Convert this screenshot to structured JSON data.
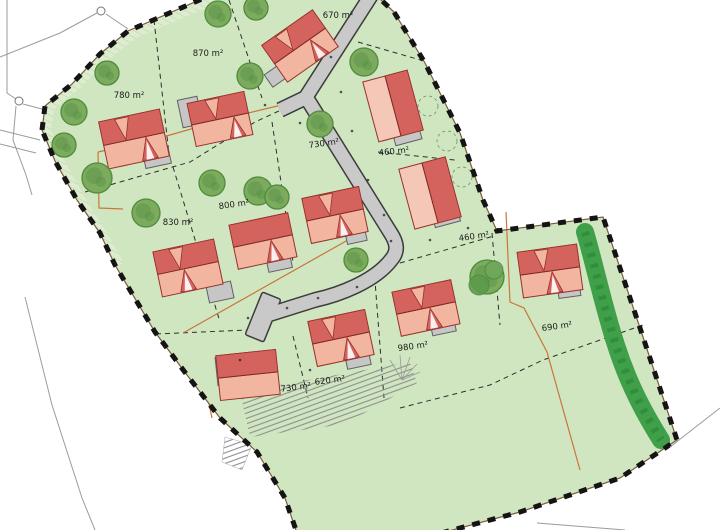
{
  "canvas": {
    "w": 720,
    "h": 530
  },
  "plots": [
    {
      "label": "670 m²",
      "x": 338,
      "y": 16,
      "rot": 0
    },
    {
      "label": "870 m²",
      "x": 208,
      "y": 54,
      "rot": 0
    },
    {
      "label": "780 m²",
      "x": 129,
      "y": 96,
      "rot": 0
    },
    {
      "label": "730 m²",
      "x": 324,
      "y": 144,
      "rot": -8
    },
    {
      "label": "460 m²",
      "x": 394,
      "y": 152,
      "rot": -6
    },
    {
      "label": "460 m²",
      "x": 474,
      "y": 237,
      "rot": -8
    },
    {
      "label": "800 m²",
      "x": 234,
      "y": 205,
      "rot": -8
    },
    {
      "label": "830 m²",
      "x": 178,
      "y": 223,
      "rot": 0
    },
    {
      "label": "730 m²",
      "x": 296,
      "y": 388,
      "rot": -7
    },
    {
      "label": "620 m²",
      "x": 330,
      "y": 381,
      "rot": -7
    },
    {
      "label": "980 m²",
      "x": 413,
      "y": 347,
      "rot": -8
    },
    {
      "label": "690 m²",
      "x": 557,
      "y": 327,
      "rot": -8
    }
  ],
  "colors": {
    "site_green": "#cfe6c0",
    "band_green": "#ddecce",
    "hatch_green": "#b7d2a5",
    "road_gray": "#c9c9c9",
    "road_edge": "#3c3c3c",
    "roof_dark": "#d4635e",
    "roof_light": "#f2b5a0",
    "roof_light2": "#f4c7b6",
    "roof_stroke": "#98302a",
    "garage_fill": "#c6c6c6",
    "garage_stroke": "#606060",
    "tree_fill": "#7cab5e",
    "tree_stroke": "#4e8c3c",
    "tree_inner": "#659a4e",
    "veg_green": "#3fa049",
    "veg_dark": "#2e8a3b",
    "dash_line": "#2e2e2e",
    "orange": "#c8763a",
    "boundary": "#141414",
    "boundary_under": "#7a5a3d",
    "outside": "#9b9b9b",
    "tick": "#8f8f8f",
    "label": "#1b1b1b"
  },
  "site": {
    "boundary": [
      [
        42,
        130
      ],
      [
        45,
        106
      ],
      [
        72,
        84
      ],
      [
        100,
        54
      ],
      [
        128,
        31
      ],
      [
        211,
        -5
      ],
      [
        378,
        -3
      ],
      [
        394,
        12
      ],
      [
        425,
        63
      ],
      [
        460,
        133
      ],
      [
        483,
        200
      ],
      [
        497,
        231
      ],
      [
        603,
        217
      ],
      [
        641,
        331
      ],
      [
        677,
        440
      ],
      [
        620,
        478
      ],
      [
        520,
        512
      ],
      [
        430,
        536
      ],
      [
        298,
        536
      ],
      [
        285,
        498
      ],
      [
        257,
        452
      ],
      [
        220,
        418
      ],
      [
        187,
        375
      ],
      [
        155,
        332
      ],
      [
        115,
        265
      ],
      [
        100,
        233
      ],
      [
        77,
        200
      ],
      [
        55,
        161
      ],
      [
        42,
        130
      ]
    ],
    "band": [
      [
        211,
        -4
      ],
      [
        128,
        31
      ],
      [
        100,
        54
      ],
      [
        72,
        84
      ],
      [
        45,
        106
      ],
      [
        42,
        130
      ],
      [
        58,
        163
      ],
      [
        78,
        202
      ],
      [
        100,
        235
      ],
      [
        116,
        266
      ],
      [
        124,
        263
      ],
      [
        107,
        233
      ],
      [
        86,
        200
      ],
      [
        65,
        162
      ],
      [
        51,
        130
      ],
      [
        54,
        109
      ],
      [
        80,
        88
      ],
      [
        107,
        61
      ],
      [
        136,
        38
      ],
      [
        216,
        4
      ]
    ],
    "plot_lines": [
      [
        [
          229,
          0
        ],
        [
          262,
          98
        ]
      ],
      [
        [
          154,
          20
        ],
        [
          170,
          163
        ]
      ],
      [
        [
          85,
          192
        ],
        [
          190,
          162
        ],
        [
          255,
          122
        ],
        [
          281,
          110
        ]
      ],
      [
        [
          173,
          167
        ],
        [
          220,
          322
        ]
      ],
      [
        [
          156,
          334
        ],
        [
          248,
          330
        ]
      ],
      [
        [
          272,
          122
        ],
        [
          293,
          262
        ]
      ],
      [
        [
          293,
          336
        ],
        [
          308,
          398
        ]
      ],
      [
        [
          374,
          268
        ],
        [
          384,
          398
        ]
      ],
      [
        [
          492,
          233
        ],
        [
          500,
          325
        ]
      ],
      [
        [
          400,
          408
        ],
        [
          490,
          385
        ],
        [
          543,
          360
        ],
        [
          643,
          325
        ]
      ],
      [
        [
          400,
          263
        ],
        [
          494,
          236
        ]
      ],
      [
        [
          378,
          152
        ],
        [
          455,
          160
        ]
      ],
      [
        [
          358,
          42
        ],
        [
          424,
          61
        ]
      ]
    ],
    "orange_lines": [
      [
        [
          98,
          152
        ],
        [
          170,
          135
        ],
        [
          240,
          115
        ],
        [
          298,
          101
        ]
      ],
      [
        [
          98,
          152
        ],
        [
          99,
          208
        ],
        [
          123,
          209
        ]
      ],
      [
        [
          183,
          333
        ],
        [
          355,
          236
        ]
      ],
      [
        [
          506,
          212
        ],
        [
          510,
          302
        ],
        [
          524,
          308
        ],
        [
          547,
          352
        ],
        [
          580,
          470
        ]
      ],
      [
        [
          209,
          404
        ],
        [
          212,
          418
        ]
      ]
    ],
    "road_path": "M372,-6 L306,97 L390,232 C398,244 398,252 391,260 C374,282 338,295 315,300 L264,316 M305,98 L280,110",
    "hammerhead": {
      "cx": 263,
      "cy": 317,
      "w": 20,
      "h": 46,
      "rot": 22
    },
    "veg_path": "M585,232 C593,258 603,305 616,345 C629,386 646,416 661,440",
    "houses": [
      {
        "cx": 300,
        "cy": 46,
        "w": 62,
        "h": 45,
        "rot": -35,
        "split": "h",
        "g": {
          "cx": 280,
          "cy": 73,
          "w": 28,
          "h": 15,
          "rot": -35
        },
        "pt": -8,
        "pb": 12
      },
      {
        "cx": 220,
        "cy": 119,
        "w": 58,
        "h": 44,
        "rot": -12,
        "split": "h",
        "g": {
          "cx": 190,
          "cy": 112,
          "w": 20,
          "h": 28,
          "rot": -12
        },
        "pt": -4,
        "pb": 14
      },
      {
        "cx": 134,
        "cy": 139,
        "w": 62,
        "h": 48,
        "rot": -12,
        "split": "h",
        "g": {
          "cx": 157,
          "cy": 158,
          "w": 26,
          "h": 16,
          "rot": -12
        },
        "pt": -8,
        "pb": 12
      },
      {
        "cx": 393,
        "cy": 106,
        "w": 46,
        "h": 62,
        "rot": -15,
        "split": "v",
        "g": {
          "cx": 407,
          "cy": 135,
          "w": 27,
          "h": 15,
          "rot": -15
        }
      },
      {
        "cx": 430,
        "cy": 193,
        "w": 48,
        "h": 62,
        "rot": -15,
        "split": "v",
        "g": {
          "cx": 446,
          "cy": 217,
          "w": 26,
          "h": 15,
          "rot": -15
        }
      },
      {
        "cx": 263,
        "cy": 241,
        "w": 60,
        "h": 45,
        "rot": -12,
        "split": "h",
        "g": {
          "cx": 279,
          "cy": 262,
          "w": 24,
          "h": 16,
          "rot": -12
        },
        "pb": 8
      },
      {
        "cx": 335,
        "cy": 215,
        "w": 58,
        "h": 46,
        "rot": -12,
        "split": "h",
        "g": {
          "cx": 356,
          "cy": 236,
          "w": 20,
          "h": 13,
          "rot": -12
        },
        "pt": -5,
        "pb": 5
      },
      {
        "cx": 188,
        "cy": 268,
        "w": 62,
        "h": 46,
        "rot": -12,
        "split": "h",
        "g": {
          "cx": 220,
          "cy": 292,
          "w": 25,
          "h": 17,
          "rot": -12
        },
        "pt": -8,
        "pb": -4
      },
      {
        "cx": 341,
        "cy": 338,
        "w": 58,
        "h": 46,
        "rot": -12,
        "split": "h",
        "g": {
          "cx": 358,
          "cy": 360,
          "w": 24,
          "h": 14,
          "rot": -12
        },
        "pt": -8,
        "pb": 6
      },
      {
        "cx": 426,
        "cy": 308,
        "w": 60,
        "h": 45,
        "rot": -12,
        "split": "h",
        "g": {
          "cx": 443,
          "cy": 326,
          "w": 24,
          "h": 15,
          "rot": -12
        },
        "pt": -4,
        "pb": 4
      },
      {
        "cx": 550,
        "cy": 271,
        "w": 60,
        "h": 46,
        "rot": -8,
        "split": "h",
        "g": {
          "cx": 569,
          "cy": 290,
          "w": 22,
          "h": 14,
          "rot": -8
        },
        "pt": -6,
        "pb": 2
      },
      {
        "cx": 248,
        "cy": 375,
        "w": 60,
        "h": 45,
        "rot": -6,
        "split": "h",
        "g": {
          "cx": 223,
          "cy": 371,
          "w": 13,
          "h": 28,
          "rot": -6
        }
      }
    ],
    "trees": [
      {
        "x": 256,
        "y": 8,
        "r": 12
      },
      {
        "x": 218,
        "y": 14,
        "r": 13
      },
      {
        "x": 107,
        "y": 73,
        "r": 12
      },
      {
        "x": 74,
        "y": 112,
        "r": 13
      },
      {
        "x": 64,
        "y": 145,
        "r": 12
      },
      {
        "x": 97,
        "y": 178,
        "r": 15
      },
      {
        "x": 146,
        "y": 213,
        "r": 14
      },
      {
        "x": 212,
        "y": 183,
        "r": 13
      },
      {
        "x": 250,
        "y": 76,
        "r": 13
      },
      {
        "x": 320,
        "y": 124,
        "r": 13
      },
      {
        "x": 364,
        "y": 62,
        "r": 14
      },
      {
        "x": 258,
        "y": 191,
        "r": 14
      },
      {
        "x": 277,
        "y": 197,
        "r": 12
      },
      {
        "x": 356,
        "y": 260,
        "r": 12
      },
      {
        "x": 487,
        "y": 277,
        "r": 17,
        "big": true
      }
    ],
    "dashed_circles": [
      {
        "x": 428,
        "y": 106
      },
      {
        "x": 447,
        "y": 141
      },
      {
        "x": 462,
        "y": 177
      }
    ],
    "hatch_band": [
      [
        240,
        392
      ],
      [
        410,
        362
      ],
      [
        417,
        383
      ],
      [
        345,
        424
      ],
      [
        250,
        437
      ]
    ],
    "hatch_wedge": [
      [
        225,
        437
      ],
      [
        252,
        445
      ],
      [
        242,
        470
      ],
      [
        222,
        462
      ]
    ],
    "fan_lines": [
      [
        [
          402,
          380
        ],
        [
          390,
          360
        ]
      ],
      [
        [
          402,
          380
        ],
        [
          400,
          355
        ]
      ],
      [
        [
          402,
          380
        ],
        [
          410,
          357
        ]
      ],
      [
        [
          402,
          380
        ],
        [
          417,
          364
        ]
      ],
      [
        [
          402,
          380
        ],
        [
          420,
          372
        ]
      ]
    ],
    "dots": [
      [
        331,
        57
      ],
      [
        341,
        92
      ],
      [
        352,
        131
      ],
      [
        368,
        180
      ],
      [
        384,
        215
      ],
      [
        391,
        241
      ],
      [
        357,
        287
      ],
      [
        318,
        298
      ],
      [
        287,
        308
      ],
      [
        300,
        123
      ],
      [
        265,
        105
      ],
      [
        248,
        318
      ],
      [
        430,
        240
      ],
      [
        468,
        228
      ],
      [
        240,
        360
      ],
      [
        310,
        370
      ]
    ],
    "outside_lines": [
      [
        [
          0,
          57
        ],
        [
          60,
          33
        ],
        [
          97,
          13
        ]
      ],
      [
        [
          106,
          14
        ],
        [
          128,
          29
        ]
      ],
      [
        [
          7,
          0
        ],
        [
          7,
          93
        ],
        [
          16,
          99
        ]
      ],
      [
        [
          23,
          104
        ],
        [
          42,
          109
        ]
      ],
      [
        [
          16,
          106
        ],
        [
          13,
          140
        ],
        [
          26,
          175
        ],
        [
          32,
          195
        ]
      ],
      [
        [
          0,
          130
        ],
        [
          40,
          140
        ]
      ],
      [
        [
          0,
          144
        ],
        [
          36,
          153
        ]
      ],
      [
        [
          25,
          297
        ],
        [
          52,
          405
        ],
        [
          82,
          498
        ],
        [
          95,
          530
        ]
      ],
      [
        [
          720,
          408
        ],
        [
          670,
          447
        ]
      ],
      [
        [
          537,
          523
        ],
        [
          625,
          530
        ]
      ]
    ],
    "survey_points": [
      [
        101,
        11
      ],
      [
        19,
        101
      ]
    ]
  }
}
